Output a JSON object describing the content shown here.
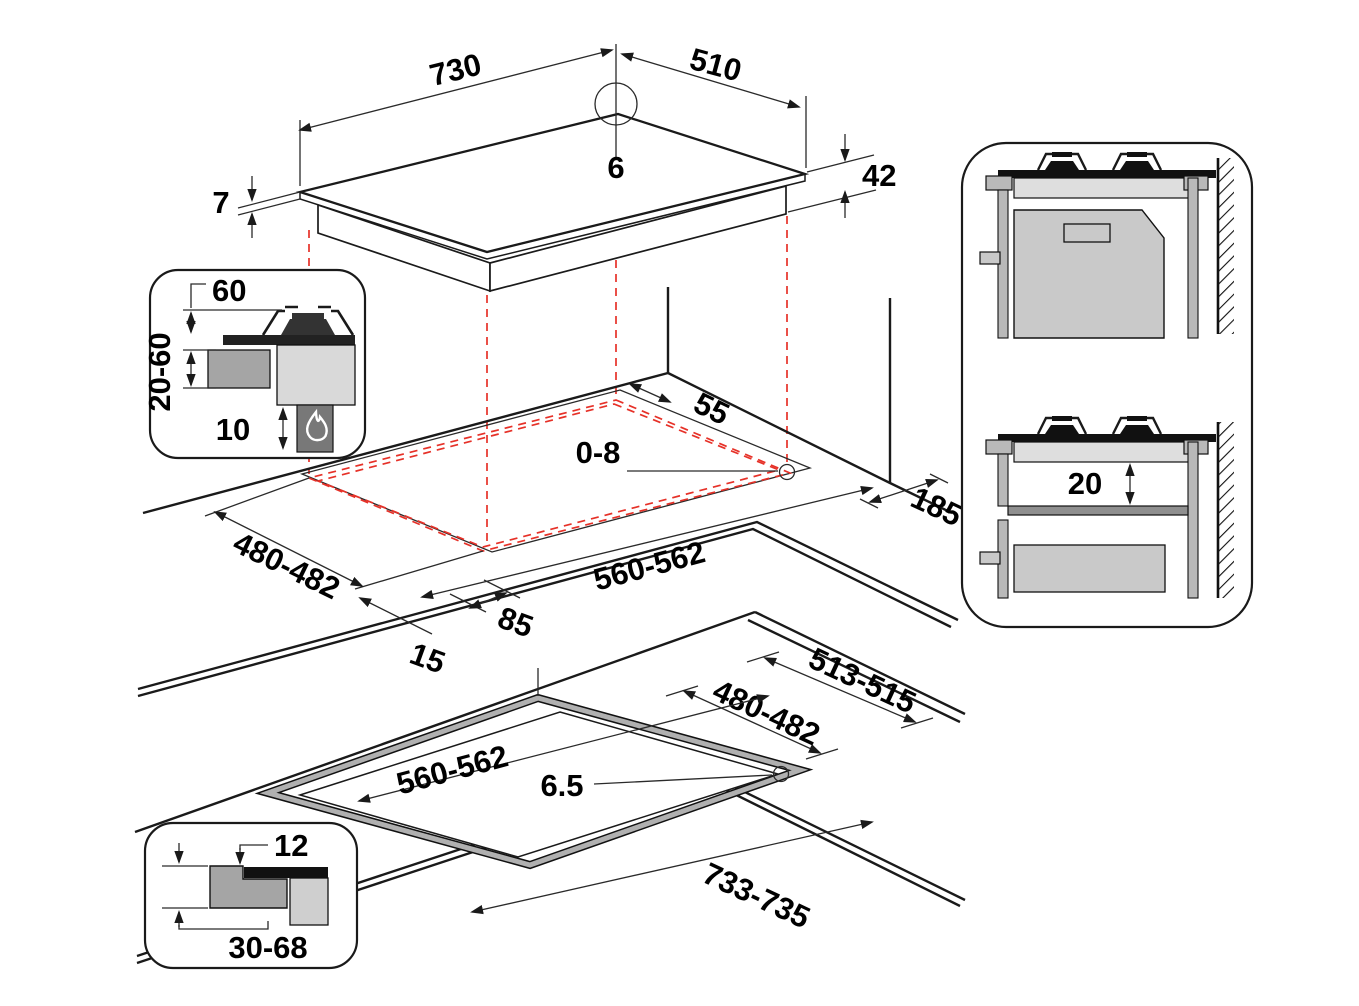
{
  "diagram_title": "Hob installation dimensions diagram",
  "top_view": {
    "width": "730",
    "depth": "510",
    "corner_radius": "6",
    "glass_thickness": "7",
    "total_height": "42"
  },
  "clearance_inset": {
    "hood_distance": "60",
    "counter_range": "20-60",
    "bottom_clearance": "10"
  },
  "cutout_view": {
    "rear_distance": "55",
    "edge_gap": "0-8",
    "wall_distance": "185",
    "cutout_depth": "480-482",
    "cutout_width": "560-562",
    "side_margin": "85",
    "rear_margin": "15"
  },
  "flush_view": {
    "recess_depth_range": "513-515",
    "cutout_depth": "480-482",
    "cutout_width": "560-562",
    "corner_gap": "6.5",
    "recess_width": "733-735"
  },
  "flush_inset": {
    "recess_depth": "12",
    "counter_range": "30-68"
  },
  "section_panel": {
    "shelf_clearance": "20"
  }
}
